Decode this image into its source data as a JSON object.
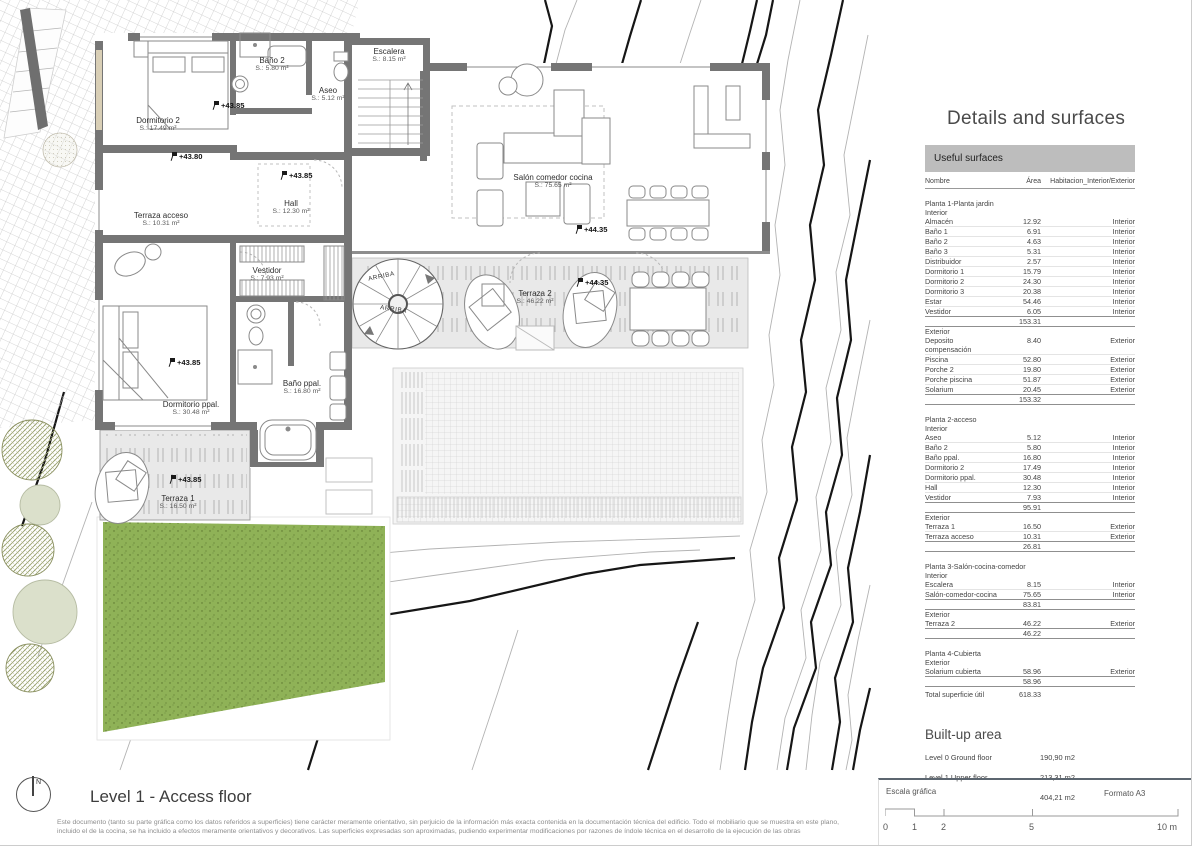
{
  "plan": {
    "rooms": [
      {
        "id": "escalera",
        "name": "Escalera",
        "area": "S.: 8.15 m²",
        "x": 389,
        "y": 47
      },
      {
        "id": "bano2",
        "name": "Baño 2",
        "area": "S.: 5.80 m²",
        "x": 272,
        "y": 56
      },
      {
        "id": "aseo",
        "name": "Aseo",
        "area": "S.: 5.12 m²",
        "x": 328,
        "y": 86
      },
      {
        "id": "dormitorio2",
        "name": "Dormitorio 2",
        "area": "S.: 17.49 m²",
        "x": 158,
        "y": 116
      },
      {
        "id": "terraza-acceso",
        "name": "Terraza acceso",
        "area": "S.: 10.31 m²",
        "x": 161,
        "y": 211
      },
      {
        "id": "hall",
        "name": "Hall",
        "area": "S.: 12.30 m²",
        "x": 291,
        "y": 199
      },
      {
        "id": "vestidor",
        "name": "Vestidor",
        "area": "S.: 7.93 m²",
        "x": 267,
        "y": 266
      },
      {
        "id": "dormitorio-ppal",
        "name": "Dormitorio ppal.",
        "area": "S.: 30.48 m²",
        "x": 191,
        "y": 400
      },
      {
        "id": "bano-ppal",
        "name": "Baño ppal.",
        "area": "S.: 16.80 m²",
        "x": 302,
        "y": 379
      },
      {
        "id": "salon",
        "name": "Salón comedor cocina",
        "area": "S.: 75.65 m²",
        "x": 553,
        "y": 173
      },
      {
        "id": "terraza2",
        "name": "Terraza 2",
        "area": "S.: 46.22 m²",
        "x": 535,
        "y": 289
      },
      {
        "id": "terraza1",
        "name": "Terraza 1",
        "area": "S.: 16.50 m²",
        "x": 178,
        "y": 494
      }
    ],
    "levels": [
      {
        "text": "+43.85",
        "x": 212,
        "y": 101
      },
      {
        "text": "+43.80",
        "x": 170,
        "y": 152
      },
      {
        "text": "+43.85",
        "x": 280,
        "y": 171
      },
      {
        "text": "+44.35",
        "x": 575,
        "y": 225
      },
      {
        "text": "+44.35",
        "x": 576,
        "y": 278
      },
      {
        "text": "+43.85",
        "x": 168,
        "y": 358
      },
      {
        "text": "+43.85",
        "x": 169,
        "y": 475
      }
    ],
    "arriba_labels": [
      "ARRIBA",
      "ARRIBA"
    ],
    "north_letter": "N"
  },
  "panel": {
    "title": "Details and surfaces",
    "surfaces": {
      "header": "Useful surfaces",
      "columns": [
        "Nombre",
        "Área",
        "Habitacion_Interior/Exterior"
      ],
      "sections": [
        {
          "title": "Planta 1-Planta jardin",
          "groups": [
            {
              "label": "Interior",
              "subtotal": "153.31",
              "rows": [
                [
                  "Almacén",
                  "12.92",
                  "Interior"
                ],
                [
                  "Baño 1",
                  "6.91",
                  "Interior"
                ],
                [
                  "Baño 2",
                  "4.63",
                  "Interior"
                ],
                [
                  "Baño 3",
                  "5.31",
                  "Interior"
                ],
                [
                  "Distribuidor",
                  "2.57",
                  "Interior"
                ],
                [
                  "Dormitorio 1",
                  "15.79",
                  "Interior"
                ],
                [
                  "Dormitorio 2",
                  "24.30",
                  "Interior"
                ],
                [
                  "Dormitorio 3",
                  "20.38",
                  "Interior"
                ],
                [
                  "Estar",
                  "54.46",
                  "Interior"
                ],
                [
                  "Vestidor",
                  "6.05",
                  "Interior"
                ]
              ]
            },
            {
              "label": "Exterior",
              "subtotal": "153.32",
              "rows": [
                [
                  "Deposito compensación",
                  "8.40",
                  "Exterior"
                ],
                [
                  "Piscina",
                  "52.80",
                  "Exterior"
                ],
                [
                  "Porche 2",
                  "19.80",
                  "Exterior"
                ],
                [
                  "Porche piscina",
                  "51.87",
                  "Exterior"
                ],
                [
                  "Solarium",
                  "20.45",
                  "Exterior"
                ]
              ]
            }
          ]
        },
        {
          "title": "Planta 2-acceso",
          "groups": [
            {
              "label": "Interior",
              "subtotal": "95.91",
              "rows": [
                [
                  "Aseo",
                  "5.12",
                  "Interior"
                ],
                [
                  "Baño 2",
                  "5.80",
                  "Interior"
                ],
                [
                  "Baño ppal.",
                  "16.80",
                  "Interior"
                ],
                [
                  "Dormitorio 2",
                  "17.49",
                  "Interior"
                ],
                [
                  "Dormitorio ppal.",
                  "30.48",
                  "Interior"
                ],
                [
                  "Hall",
                  "12.30",
                  "Interior"
                ],
                [
                  "Vestidor",
                  "7.93",
                  "Interior"
                ]
              ]
            },
            {
              "label": "Exterior",
              "subtotal": "26.81",
              "rows": [
                [
                  "Terraza 1",
                  "16.50",
                  "Exterior"
                ],
                [
                  "Terraza acceso",
                  "10.31",
                  "Exterior"
                ]
              ]
            }
          ]
        },
        {
          "title": "Planta 3-Salón-cocina-comedor",
          "groups": [
            {
              "label": "Interior",
              "subtotal": "83.81",
              "rows": [
                [
                  "Escalera",
                  "8.15",
                  "Interior"
                ],
                [
                  "Salón-comedor-cocina",
                  "75.65",
                  "Interior"
                ]
              ]
            },
            {
              "label": "Exterior",
              "subtotal": "46.22",
              "rows": [
                [
                  "Terraza 2",
                  "46.22",
                  "Exterior"
                ]
              ]
            }
          ]
        },
        {
          "title": "Planta 4-Cubierta",
          "groups": [
            {
              "label": "Exterior",
              "subtotal": "58.96",
              "rows": [
                [
                  "Solarium cubierta",
                  "58.96",
                  "Exterior"
                ]
              ]
            }
          ]
        }
      ],
      "total_label": "Total superficie útil",
      "total": "618.33"
    },
    "built_up": {
      "title": "Built-up area",
      "rows": [
        [
          "Level 0 Ground floor",
          "190,90 m2"
        ],
        [
          "Level 1 Upper floor",
          "213,31 m2"
        ],
        [
          "",
          "404,21 m2"
        ]
      ]
    }
  },
  "title_block": {
    "title": "Level 1 - Access floor",
    "disclaimer": "Este documento (tanto su parte gráfica como los datos referidos a superficies) tiene carácter meramente orientativo, sin perjuicio de la información más exacta contenida en la documentación técnica del edificio. Todo el mobiliario que se muestra en este plano, incluido el de la cocina, se ha incluido a efectos meramente orientativos y decorativos. Las superficies expresadas son aproximadas, pudiendo experimentar modificaciones por razones de índole técnica en el desarrollo de la ejecución de las obras"
  },
  "scale": {
    "label": "Escala gráfica",
    "format": "Formato A3",
    "ticks": [
      "0",
      "1",
      "2",
      "5"
    ],
    "last": "10 m"
  },
  "colors": {
    "wall": "#757575",
    "grass": "#8fb257",
    "terrace": "#e9e9e9",
    "contour_dark": "#161616",
    "contour_light": "#b3b3b3"
  }
}
